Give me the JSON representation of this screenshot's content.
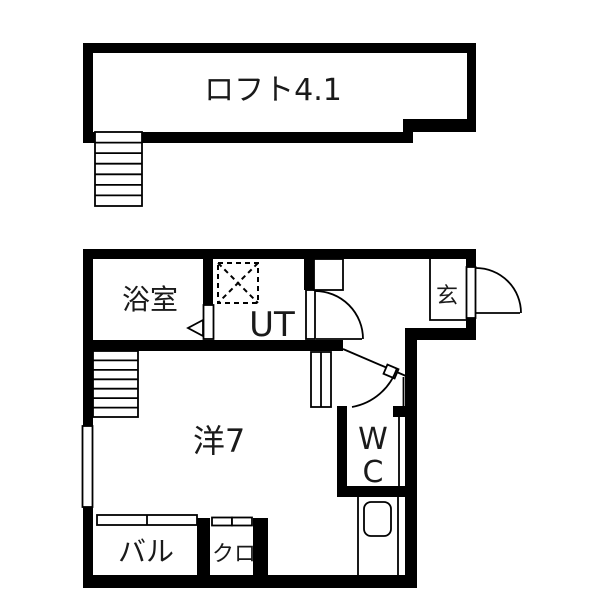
{
  "drawing": {
    "type": "floor-plan",
    "units": "jo (tatami-count labels)",
    "colors": {
      "wall": "#000000",
      "background": "#ffffff",
      "line": "#1a1a1a"
    }
  },
  "floors": {
    "loft": {
      "label": "ロフト4.1",
      "features": [
        "stairs"
      ]
    },
    "main": {
      "bathroom": {
        "label": "浴室"
      },
      "utility": {
        "label": "UT",
        "features": [
          "washing-machine-pan-dashed"
        ]
      },
      "entrance": {
        "label": "玄",
        "features": [
          "entry-door-swing",
          "shoe-cabinet",
          "step-line"
        ]
      },
      "western_room": {
        "label": "洋7",
        "features": [
          "stairs",
          "window",
          "sliding-partition"
        ]
      },
      "toilet": {
        "label_line1": "W",
        "label_line2": "C",
        "features": [
          "sink-below"
        ]
      },
      "balcony": {
        "label": "バル",
        "features": [
          "sliding-window"
        ]
      },
      "closet": {
        "label": "クロ",
        "features": [
          "sliding-doors"
        ]
      }
    }
  }
}
